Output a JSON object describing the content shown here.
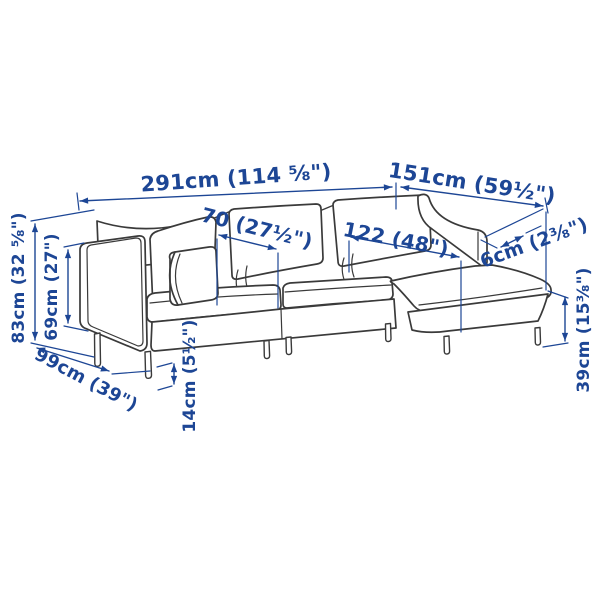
{
  "diagram": {
    "description": "Line-drawing dimension diagram of a sofa with chaise longue",
    "colors": {
      "background": "#ffffff",
      "line_art": "#3a3a3a",
      "dimension_blue": "#1d4695"
    },
    "labels": {
      "total_width": "291cm (114 ⅝\")",
      "chaise_length": "151cm (59½\")",
      "seat_width": "70 (27½\")",
      "chaise_seat_width": "122 (48\")",
      "armrest_width": "6cm (2⅜\")",
      "back_height": "83cm (32 ⅝\")",
      "armrest_height": "69cm (27\")",
      "depth": "99cm (39\")",
      "leg_height": "14cm (5½\")",
      "seat_height": "39cm (15⅜\")"
    },
    "measurements": [
      {
        "name": "total-width",
        "cm": 291,
        "inches": "114 5/8"
      },
      {
        "name": "chaise-length",
        "cm": 151,
        "inches": "59 1/2"
      },
      {
        "name": "seat-width",
        "cm": 70,
        "inches": "27 1/2"
      },
      {
        "name": "chaise-seat-width",
        "cm": 122,
        "inches": "48"
      },
      {
        "name": "armrest-width",
        "cm": 6,
        "inches": "2 3/8"
      },
      {
        "name": "back-height",
        "cm": 83,
        "inches": "32 5/8"
      },
      {
        "name": "armrest-height",
        "cm": 69,
        "inches": "27"
      },
      {
        "name": "depth",
        "cm": 99,
        "inches": "39"
      },
      {
        "name": "leg-height",
        "cm": 14,
        "inches": "5 1/2"
      },
      {
        "name": "seat-height",
        "cm": 39,
        "inches": "15 3/8"
      }
    ]
  }
}
